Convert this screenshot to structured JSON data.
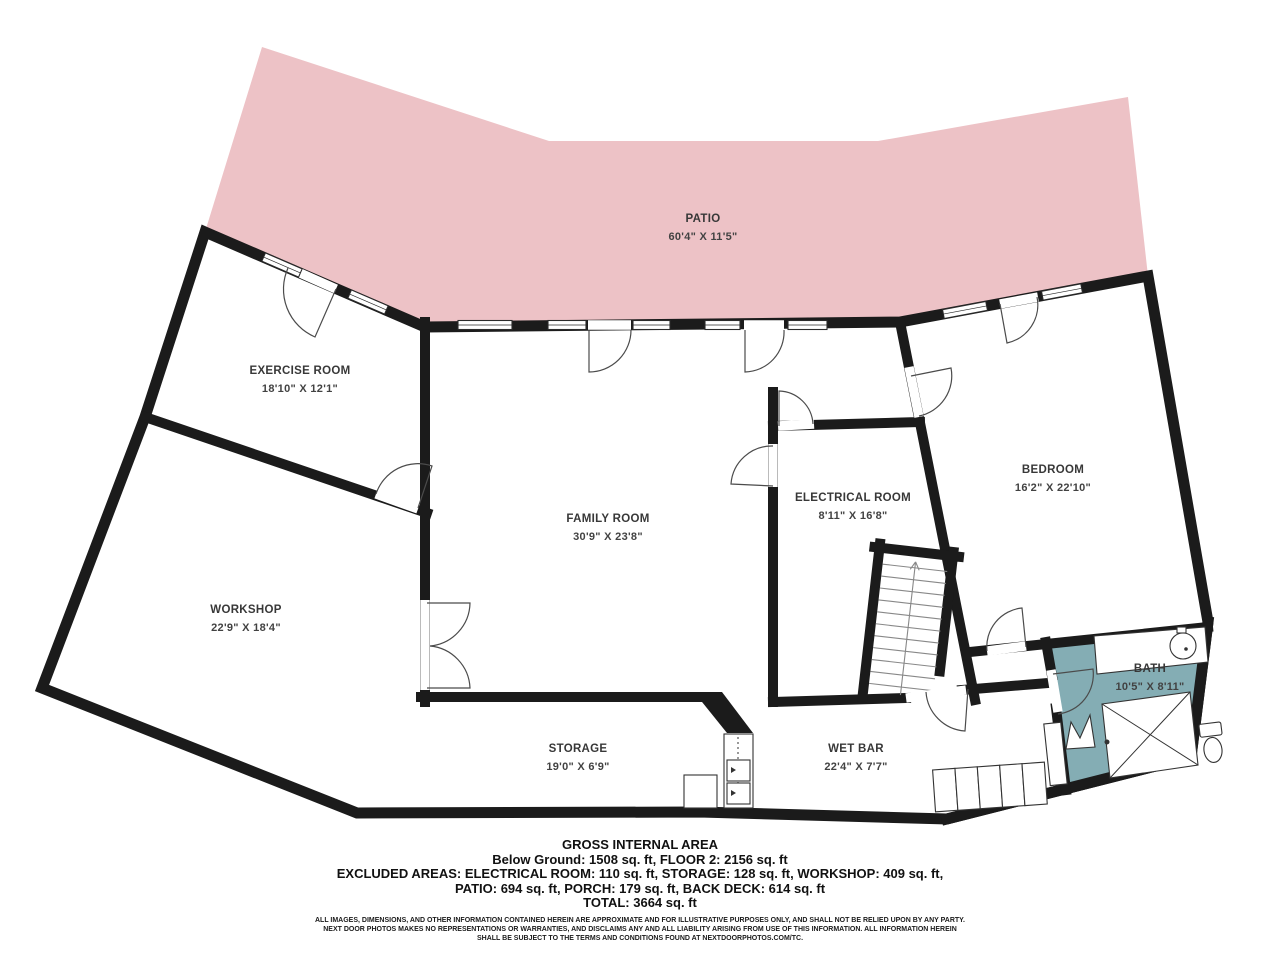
{
  "floorplan": {
    "colors": {
      "patio": "#edc2c6",
      "floor": "#e7e5d9",
      "bath": "#84adb4",
      "wall": "#1b1b1b",
      "background": "#ffffff"
    },
    "rooms": [
      {
        "name": "PATIO",
        "dims": "60'4\" X 11'5\""
      },
      {
        "name": "EXERCISE ROOM",
        "dims": "18'10\" X 12'1\""
      },
      {
        "name": "FAMILY ROOM",
        "dims": "30'9\" X 23'8\""
      },
      {
        "name": "ELECTRICAL ROOM",
        "dims": "8'11\" X 16'8\""
      },
      {
        "name": "BEDROOM",
        "dims": "16'2\" X 22'10\""
      },
      {
        "name": "WORKSHOP",
        "dims": "22'9\" X 18'4\""
      },
      {
        "name": "STORAGE",
        "dims": "19'0\" X 6'9\""
      },
      {
        "name": "WET BAR",
        "dims": "22'4\" X 7'7\""
      },
      {
        "name": "BATH",
        "dims": "10'5\" X 8'11\""
      }
    ]
  },
  "footer": {
    "title": "GROSS INTERNAL AREA",
    "line1": "Below Ground: 1508 sq. ft, FLOOR 2: 2156 sq. ft",
    "line2": "EXCLUDED AREAS: ELECTRICAL ROOM: 110 sq. ft, STORAGE: 128 sq. ft, WORKSHOP: 409 sq. ft,",
    "line3": "PATIO: 694 sq. ft, PORCH: 179 sq. ft, BACK DECK: 614 sq. ft",
    "total": "TOTAL: 3664 sq. ft",
    "disclaimer1": "ALL IMAGES, DIMENSIONS, AND OTHER INFORMATION CONTAINED HEREIN ARE APPROXIMATE AND FOR ILLUSTRATIVE PURPOSES ONLY, AND SHALL NOT BE RELIED UPON BY ANY PARTY.",
    "disclaimer2": "NEXT DOOR PHOTOS MAKES NO REPRESENTATIONS OR WARRANTIES, AND DISCLAIMS ANY AND ALL LIABILITY ARISING FROM USE OF THIS INFORMATION. ALL INFORMATION HEREIN",
    "disclaimer3": "SHALL BE SUBJECT TO THE TERMS AND CONDITIONS FOUND AT NEXTDOORPHOTOS.COM/TC."
  }
}
